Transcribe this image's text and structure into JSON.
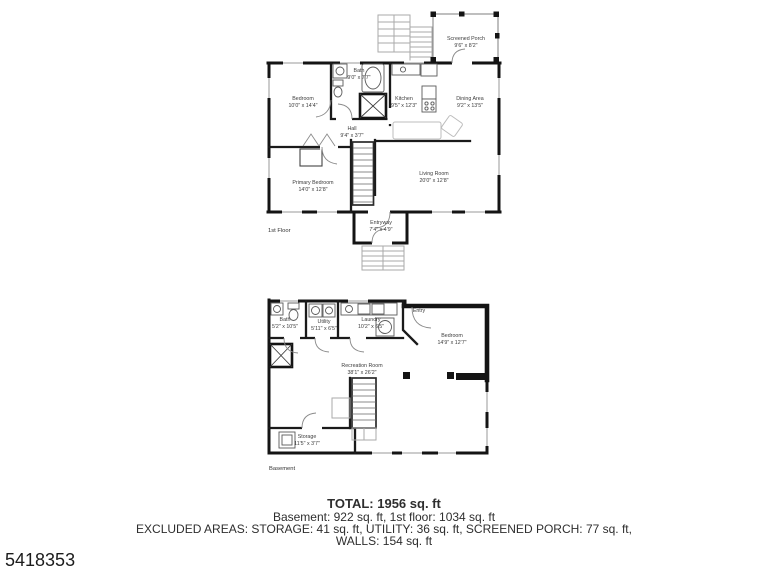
{
  "page": {
    "listing_id": "5418353"
  },
  "first_floor": {
    "floor_label": "1st Floor",
    "rooms": {
      "screened_porch": {
        "name": "Screened Porch",
        "dims": "9'6\" x 8'2\""
      },
      "bedroom": {
        "name": "Bedroom",
        "dims": "10'0\" x 14'4\""
      },
      "bath": {
        "name": "Bath",
        "dims": "9'0\" x 7'7\""
      },
      "kitchen": {
        "name": "Kitchen",
        "dims": "9'5\" x 12'3\""
      },
      "dining": {
        "name": "Dining Area",
        "dims": "9'2\" x 13'5\""
      },
      "hall": {
        "name": "Hall",
        "dims": "9'4\" x 3'7\""
      },
      "primary_bedroom": {
        "name": "Primary Bedroom",
        "dims": "14'0\" x 12'8\""
      },
      "living_room": {
        "name": "Living Room",
        "dims": "20'0\" x 12'8\""
      },
      "entryway": {
        "name": "Entryway",
        "dims": "7'4\" x 4'9\""
      }
    }
  },
  "basement": {
    "floor_label": "Basement",
    "rooms": {
      "bath": {
        "name": "Bath",
        "dims": "5'2\" x 10'5\""
      },
      "utility": {
        "name": "Utility",
        "dims": "5'11\" x 6'5\""
      },
      "laundry": {
        "name": "Laundry",
        "dims": "10'2\" x 6'5\""
      },
      "entry": {
        "name": "Entry",
        "dims": ""
      },
      "bedroom": {
        "name": "Bedroom",
        "dims": "14'9\" x 12'7\""
      },
      "recreation": {
        "name": "Recreation Room",
        "dims": "38'1\" x 26'2\""
      },
      "storage": {
        "name": "Storage",
        "dims": "11'5\" x 3'7\""
      }
    }
  },
  "summary": {
    "total": "TOTAL: 1956 sq. ft",
    "line2": "Basement: 922 sq. ft, 1st floor: 1034 sq. ft",
    "line3": "EXCLUDED AREAS: STORAGE: 41 sq. ft, UTILITY: 36 sq. ft, SCREENED PORCH: 77 sq. ft,",
    "line4": "WALLS: 154 sq. ft"
  }
}
